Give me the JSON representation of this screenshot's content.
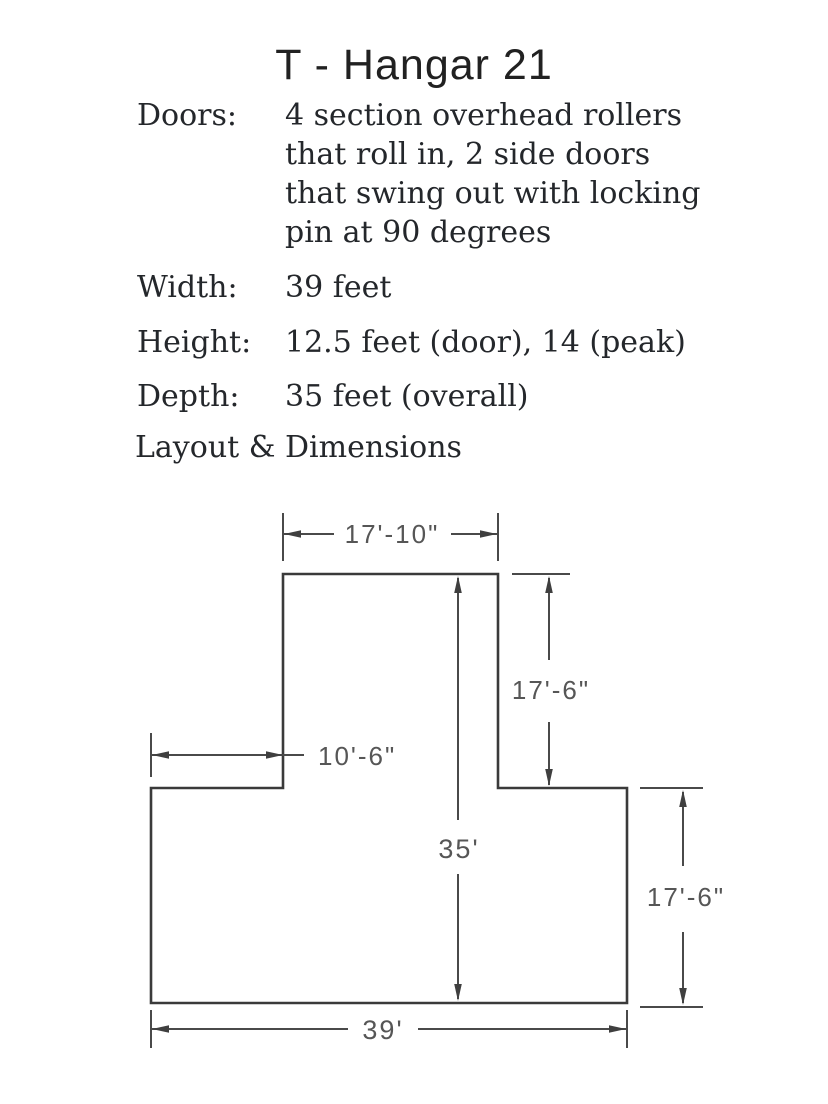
{
  "page": {
    "title": "T - Hangar 21",
    "section_heading": "Layout & Dimensions",
    "background": "#ffffff",
    "text_color": "#24272b"
  },
  "specs": [
    {
      "label": "Doors:",
      "lines": [
        "4 section overhead rollers",
        "that roll in, 2 side doors",
        "that swing out with locking",
        "pin at 90 degrees"
      ]
    },
    {
      "label": "Width:",
      "lines": [
        "39 feet"
      ]
    },
    {
      "label": "Height:",
      "lines": [
        "12.5 feet (door), 14 (peak)"
      ]
    },
    {
      "label": "Depth:",
      "lines": [
        "35 feet (overall)"
      ]
    }
  ],
  "diagram": {
    "type": "floor-plan",
    "shape": "T-hangar footprint",
    "ink_color": "#3a3a3a",
    "dim_line_color": "#4a4a4a",
    "dim_text_color": "#565656",
    "dimensions": [
      {
        "name": "top-width",
        "label": "17'-10\""
      },
      {
        "name": "upper-right-depth",
        "label": "17'-6\""
      },
      {
        "name": "left-wing-width",
        "label": "10'-6\""
      },
      {
        "name": "overall-depth",
        "label": "35'"
      },
      {
        "name": "lower-right-depth",
        "label": "17'-6\""
      },
      {
        "name": "overall-width",
        "label": "39'"
      }
    ]
  }
}
